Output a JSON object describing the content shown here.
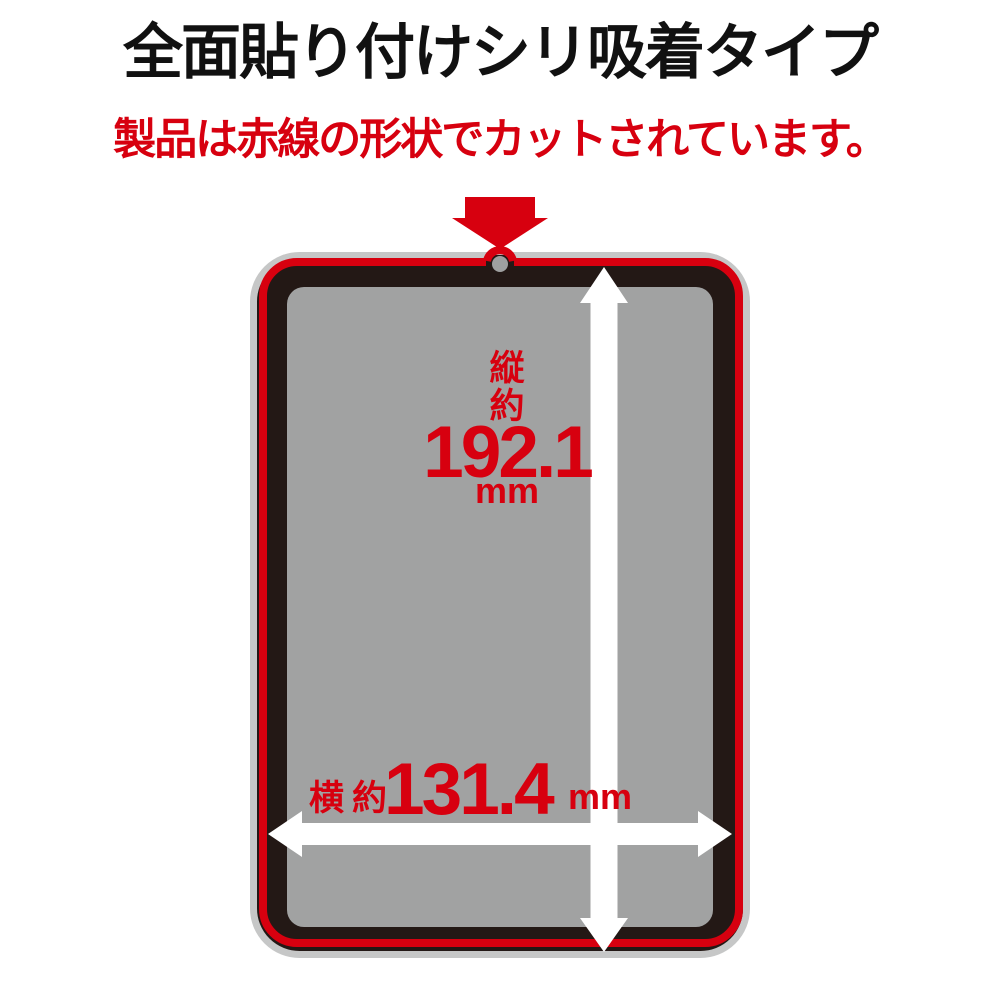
{
  "title": "全面貼り付けシリ吸着タイプ",
  "subtitle": "製品は赤線の形状でカットされています。",
  "dimensions": {
    "height": {
      "axis": "縦",
      "approx": "約",
      "value": "192.1",
      "unit": "mm"
    },
    "width": {
      "axis": "横",
      "approx": "約",
      "value": "131.4",
      "unit": "mm"
    }
  },
  "icons": {
    "top_pointer": "red-down-arrow",
    "height_measure": "white-double-arrow-vertical",
    "width_measure": "white-double-arrow-horizontal",
    "camera": "front-camera-hole"
  },
  "colors": {
    "accent_red": "#d7000f",
    "bezel_black": "#231815",
    "screen_gray": "#a1a2a2",
    "edge_silver": "#c6c7c7",
    "arrow_white": "#ffffff",
    "title_black": "#111111"
  }
}
